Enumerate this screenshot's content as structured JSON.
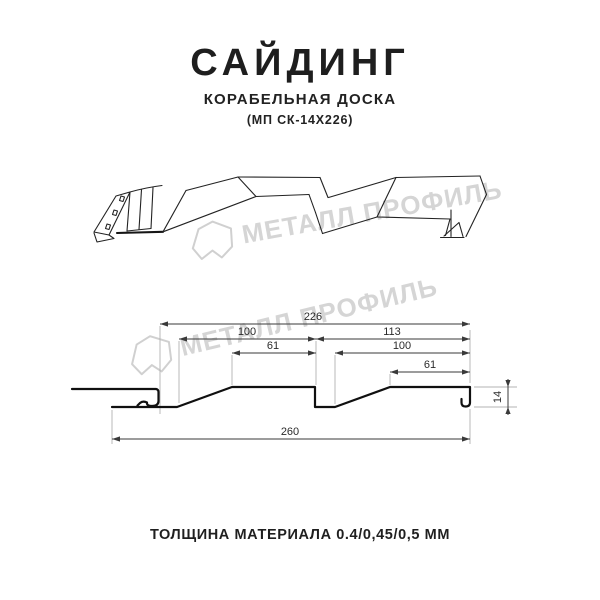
{
  "header": {
    "title": "САЙДИНГ",
    "subtitle": "КОРАБЕЛЬНАЯ ДОСКА",
    "model": "(МП СК-14Х226)"
  },
  "watermark": {
    "text": "МЕТАЛЛ ПРОФИЛЬ"
  },
  "section": {
    "dims": {
      "total_top": "226",
      "left_100": "100",
      "right_113": "113",
      "left_61": "61",
      "right_100": "100",
      "right_61": "61",
      "overall": "260",
      "height": "14"
    }
  },
  "footer": {
    "thickness": "ТОЛЩИНА МАТЕРИАЛА 0.4/0,45/0,5 ММ"
  }
}
